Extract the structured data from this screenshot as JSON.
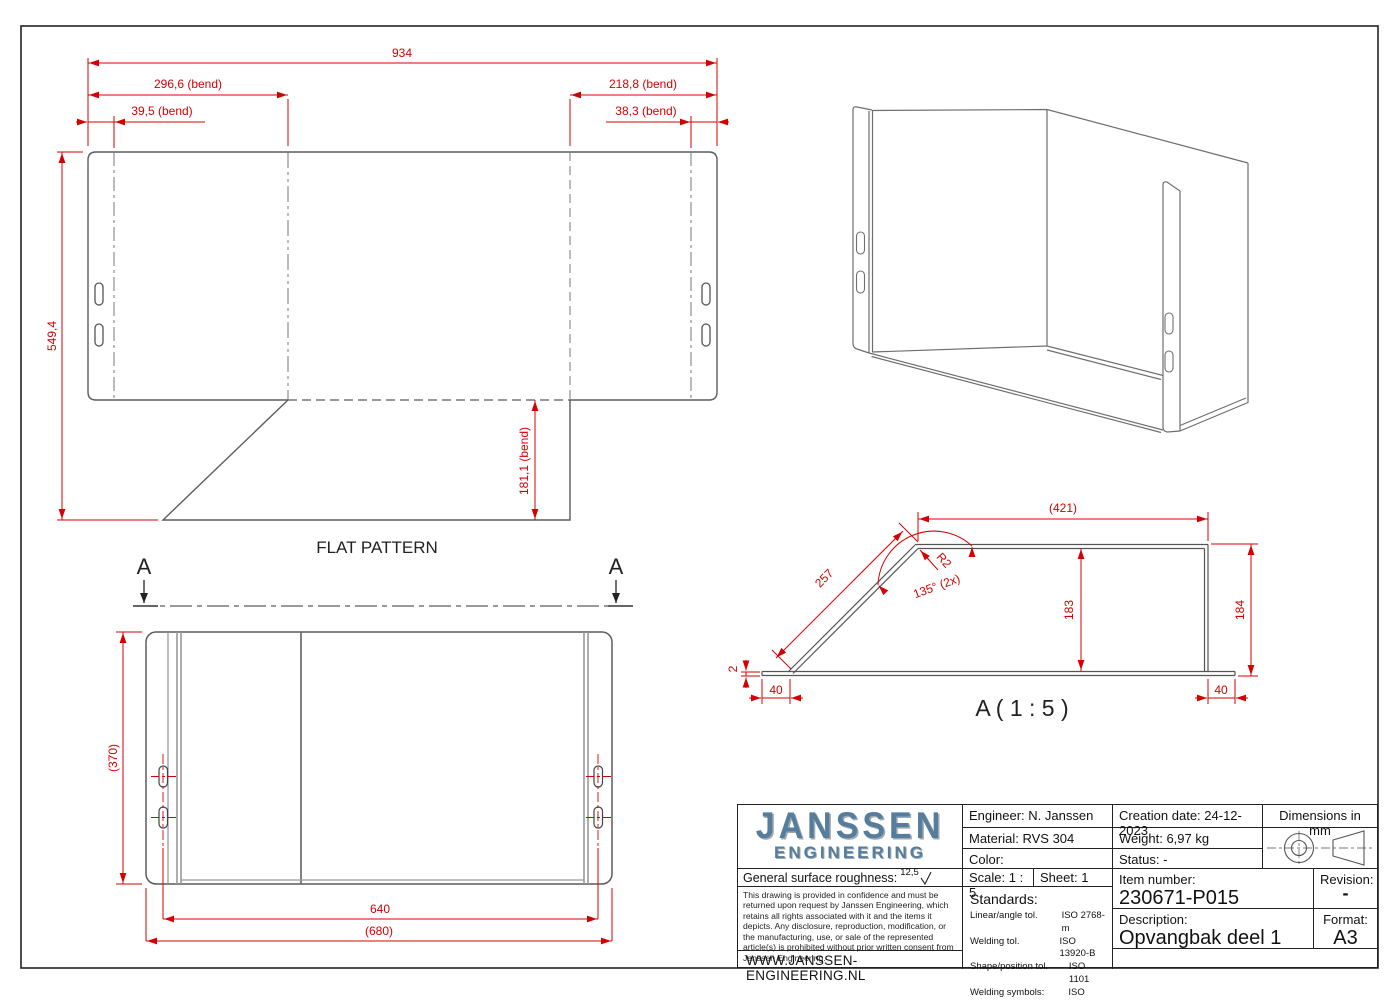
{
  "colors": {
    "dimension_red": "#d40000",
    "geometry_gray": "#6b6b6b",
    "logo_blue": "#567d9c",
    "frame_black": "#222222"
  },
  "flat": {
    "label": "FLAT PATTERN",
    "d934": "934",
    "d2966": "296,6 (bend)",
    "d395": "39,5 (bend)",
    "d2188": "218,8 (bend)",
    "d383": "38,3 (bend)",
    "d5494": "549,4",
    "d1811": "181,1 (bend)"
  },
  "section_marker": "A",
  "top_view": {
    "d370": "(370)",
    "d640": "640",
    "d680": "(680)"
  },
  "section": {
    "label": "A ( 1 : 5 )",
    "d421": "(421)",
    "d257": "257",
    "r2": "R2",
    "angle": "135° (2x)",
    "d183": "183",
    "d184": "184",
    "d40_left": "40",
    "d40_right": "40",
    "d2": "2"
  },
  "title_block": {
    "logo_line1": "JANSSEN",
    "logo_line2": "ENGINEERING",
    "roughness_label": "General surface roughness:",
    "roughness_value": "12,5",
    "legal": "This drawing is provided in confidence and must be returned upon request by Janssen Engineering, which retains all rights associated with it and the items it depicts. Any disclosure, reproduction, modification, or the manufacturing, use, or sale of the represented article(s) is prohibited without prior written consent from Janssen Engineering.",
    "website": "WWW.JANSSEN-ENGINEERING.NL",
    "engineer": "Engineer: N. Janssen",
    "material": "Material: RVS 304",
    "color": "Color:",
    "scale": "Scale: 1 : 5",
    "sheet": "Sheet: 1",
    "standards_label": "Standards:",
    "standards": [
      {
        "name": "Linear/angle tol.",
        "value": "ISO 2768-m"
      },
      {
        "name": "Welding tol.",
        "value": "ISO 13920-B"
      },
      {
        "name": "Shape/position tol.",
        "value": "ISO 1101"
      },
      {
        "name": "Welding symbols:",
        "value": "ISO 2553"
      }
    ],
    "creation_date": "Creation date: 24-12-2023",
    "dimensions_note": "Dimensions in mm",
    "weight": "Weight: 6,97 kg",
    "status": "Status: -",
    "item_number_label": "Item number:",
    "item_number": "230671-P015",
    "revision_label": "Revision:",
    "revision": "-",
    "description_label": "Description:",
    "description": "Opvangbak deel 1",
    "format_label": "Format:",
    "format": "A3"
  }
}
